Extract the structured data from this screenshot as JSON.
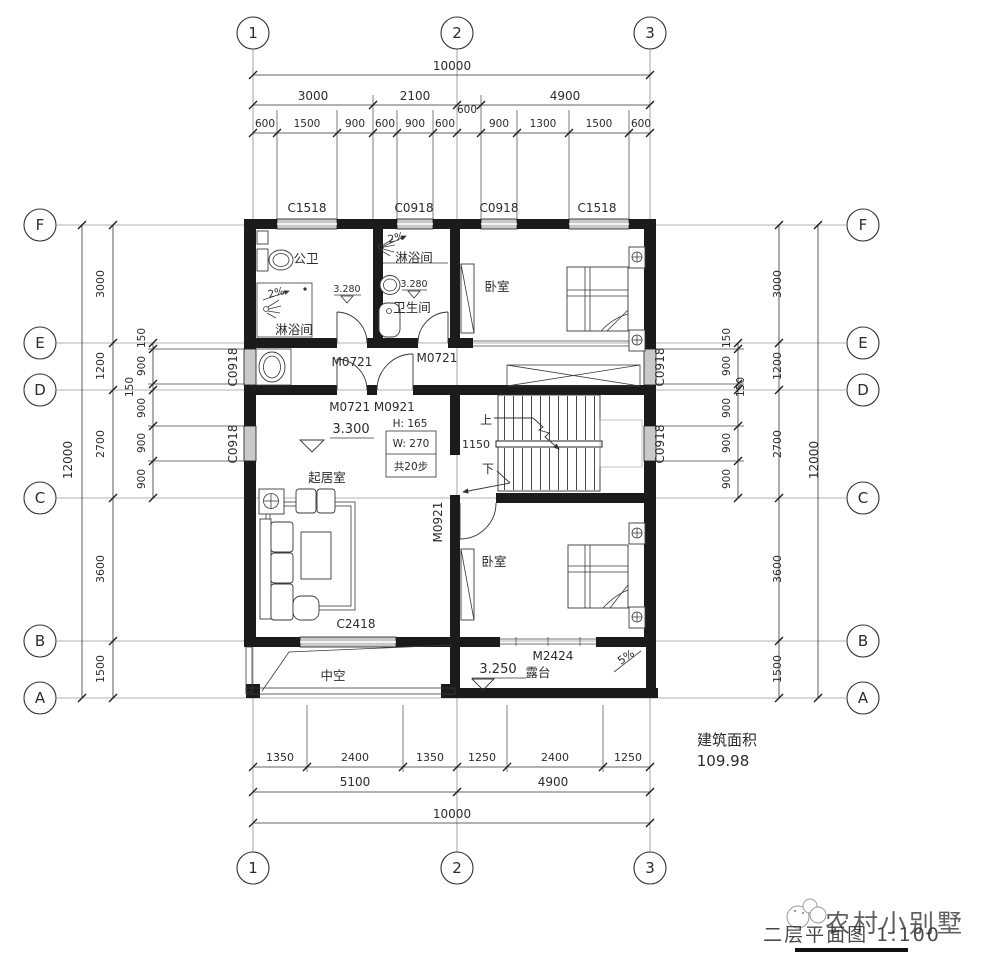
{
  "title_block": {
    "drawing_title": "二层平面图 1:100",
    "watermark": "农村小别墅",
    "area_label": "建筑面积",
    "area_value": "109.98"
  },
  "axes": {
    "top": [
      "1",
      "2",
      "3"
    ],
    "bottom": [
      "1",
      "2",
      "3"
    ],
    "left": [
      "F",
      "E",
      "D",
      "C",
      "B",
      "A"
    ],
    "right": [
      "F",
      "E",
      "D",
      "C",
      "B",
      "A"
    ]
  },
  "dims": {
    "top_total": "10000",
    "top_row2": [
      "3000",
      "2100",
      "4900"
    ],
    "top_600": "600",
    "top_row3": [
      "600",
      "1500",
      "900",
      "600",
      "900",
      "600",
      "900",
      "1300",
      "1500",
      "600"
    ],
    "bottom_row1": [
      "1350",
      "2400",
      "1350",
      "1250",
      "2400",
      "1250"
    ],
    "bottom_row2": [
      "5100",
      "4900"
    ],
    "bottom_total": "10000",
    "left_total": "12000",
    "left_main": [
      "3000",
      "1200",
      "2700",
      "3600",
      "1500"
    ],
    "left_sub": [
      "150",
      "900",
      "150",
      "900",
      "900",
      "900"
    ],
    "right_total": "12000",
    "right_main": [
      "3000",
      "1200",
      "2700",
      "3600",
      "1500"
    ],
    "right_sub": [
      "150",
      "900",
      "150",
      "900",
      "900",
      "900"
    ]
  },
  "windows": {
    "top": [
      "C1518",
      "C0918",
      "C0918",
      "C1518"
    ],
    "left": [
      "C0918",
      "C0918"
    ],
    "right": [
      "C0918",
      "C0918"
    ],
    "south": "C2418"
  },
  "doors": {
    "m0721_a": "M0721",
    "m0721_b": "M0721",
    "m_pair": "M0721 M0921",
    "m0921": "M0921",
    "m2424": "M2424"
  },
  "rooms": {
    "bath_public": "公卫",
    "shower_a": "淋浴间",
    "shower_b": "淋浴间",
    "bathroom": "卫生间",
    "bedroom_top": "卧室",
    "living": "起居室",
    "bedroom_bottom": "卧室",
    "void": "中空",
    "terrace": "露台"
  },
  "levels": {
    "living": "3.300",
    "bath_a": "3.280",
    "bath_b": "3.280",
    "terrace": "3.250"
  },
  "stair": {
    "up": "上",
    "down": "下",
    "width": "1150",
    "height_note": "H: 165",
    "width_note": "W: 270",
    "steps_note": "共20步"
  },
  "slopes": {
    "a": "2%",
    "b": "2%",
    "terrace": "5%"
  }
}
